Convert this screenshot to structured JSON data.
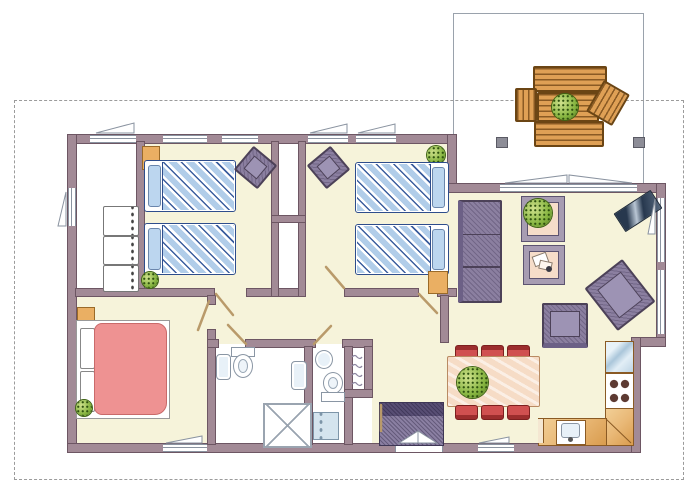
{
  "meta": {
    "kind": "architectural-floor-plan",
    "has_text": false
  },
  "colors": {
    "wall": "#a28a96",
    "wall_outline": "#6d5663",
    "floor_cream": "#f6f3da",
    "floor_white": "#ffffff",
    "boundary_dash": "#9b9b9b",
    "terrace_outline": "#9aa2ac",
    "window_line": "#8a93a0",
    "wood": "#dfa055",
    "wood_line": "#8a5a24",
    "bed_stripe_blue": "#b1cde9",
    "bed_stripe_navy": "#3c5e9e",
    "bed_outline": "#2e4d8c",
    "pillow_blue": "#bcd6ef",
    "master_bed_pink": "#ee9292",
    "upholstery_purple": "#8b7fa0",
    "upholstery_outline": "#4c4158",
    "dining_chair_red": "#d05050",
    "plant_green": "#85b43f",
    "counter_tan": "#e9b876",
    "glass_blue": "#c5daea",
    "doormat_purple": "#8a7fa2",
    "fixture_outline": "#8a96a4",
    "stove_burner": "#5d3a32",
    "nightstand_orange": "#eaaf63",
    "door_leaf_tan": "#b99a6a"
  },
  "plot": {
    "boundary_style": "dashed-property-line",
    "terrace": {
      "furniture": [
        "bench",
        "garden-table",
        "potted-plant",
        "garden-chair",
        "garden-chair",
        "bench",
        "roof-post",
        "roof-post"
      ]
    },
    "rooms": [
      {
        "name": "hall",
        "furniture": [
          "dresser",
          "dresser",
          "dresser"
        ]
      },
      {
        "name": "bedroom-1",
        "furniture": [
          "single-bed",
          "single-bed",
          "chair",
          "cabinet",
          "plant"
        ]
      },
      {
        "name": "closets",
        "furniture": [
          "closet",
          "closet"
        ]
      },
      {
        "name": "bedroom-2",
        "furniture": [
          "single-bed",
          "single-bed",
          "chair",
          "nightstand",
          "plant"
        ]
      },
      {
        "name": "master-bedroom",
        "furniture": [
          "double-bed",
          "nightstand",
          "plant"
        ]
      },
      {
        "name": "bathroom-1",
        "furniture": [
          "washbasin",
          "toilet",
          "washbasin",
          "shower"
        ]
      },
      {
        "name": "bathroom-2",
        "furniture": [
          "washbasin",
          "toilet",
          "washing-machine"
        ]
      },
      {
        "name": "linen-closet",
        "furniture": [
          "shelves"
        ]
      },
      {
        "name": "entry",
        "furniture": [
          "doormat",
          "double-entrance-door"
        ]
      },
      {
        "name": "living-room",
        "furniture": [
          "sofa",
          "side-table",
          "potted-plant",
          "side-table",
          "tv",
          "armchair",
          "armchair"
        ]
      },
      {
        "name": "dining-area",
        "furniture": [
          "dining-table",
          "potted-plant",
          "chair",
          "chair",
          "chair",
          "chair",
          "chair",
          "chair"
        ]
      },
      {
        "name": "kitchen",
        "furniture": [
          "fridge",
          "stove",
          "corner-counter",
          "counter",
          "kitchen-sink"
        ]
      }
    ]
  }
}
